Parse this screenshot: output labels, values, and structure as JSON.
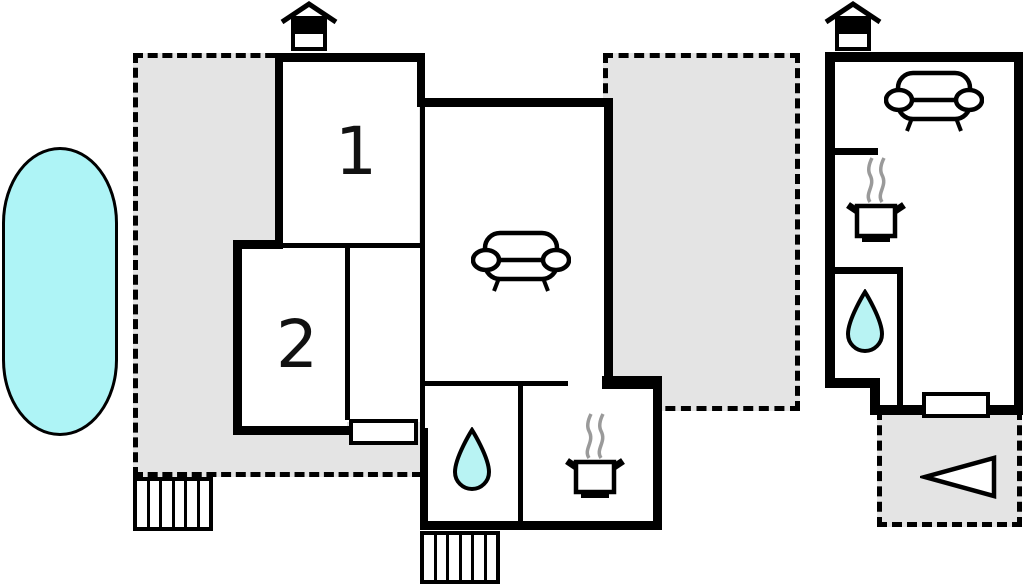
{
  "plan_title": "holiday-home-floor-plan",
  "colors": {
    "wall": "#000000",
    "terrace_fill": "#e4e4e4",
    "pool_fill": "#aef4f6",
    "water_fill": "#b8f3f3",
    "steam": "#9a9a9a",
    "background": "#ffffff"
  },
  "rooms": [
    {
      "id": "room-1",
      "label": "1"
    },
    {
      "id": "room-2",
      "label": "2"
    }
  ],
  "features": {
    "pool": "swimming-pool",
    "terraces": [
      "terrace-left",
      "terrace-middle",
      "terrace-bottom-right"
    ],
    "buildings": [
      "main-house",
      "annex-house"
    ],
    "icons": [
      "chimney-icon",
      "sofa-icon",
      "stove-pot-icon",
      "steam-icon",
      "water-drop-icon",
      "stairs-icon",
      "window-marker",
      "arrow-left-icon"
    ]
  }
}
